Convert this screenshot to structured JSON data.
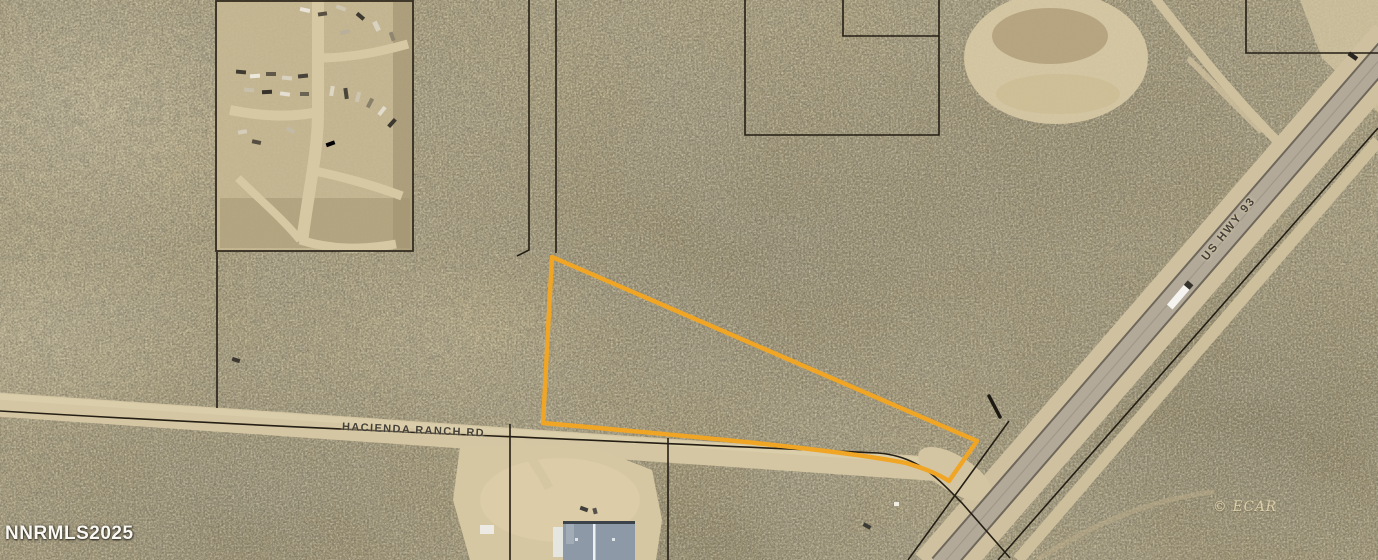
{
  "map": {
    "type": "aerial-parcel-map",
    "road_labels": {
      "hacienda": "HACIENDA RANCH RD",
      "us_hwy": "US HWY 93"
    },
    "watermarks": {
      "mls": "NNRMLS2025",
      "copyright": "© ECAR"
    },
    "features": {
      "highlighted_parcel": "triangular lot outlined in orange between Hacienda Ranch Rd and US Hwy 93",
      "junkyard": "fenced salvage yard upper left",
      "warehouse": "blue-roofed building lower center"
    },
    "colors": {
      "parcel_highlight": "#F0A524",
      "parcel_line": "#241E14",
      "road_label_text": "#44403A",
      "watermark_text": "#FAF8F3",
      "copyright_text": "#E3D6AE",
      "pavement": "#B2A999",
      "dirt_road": "#D4C6A3"
    }
  }
}
